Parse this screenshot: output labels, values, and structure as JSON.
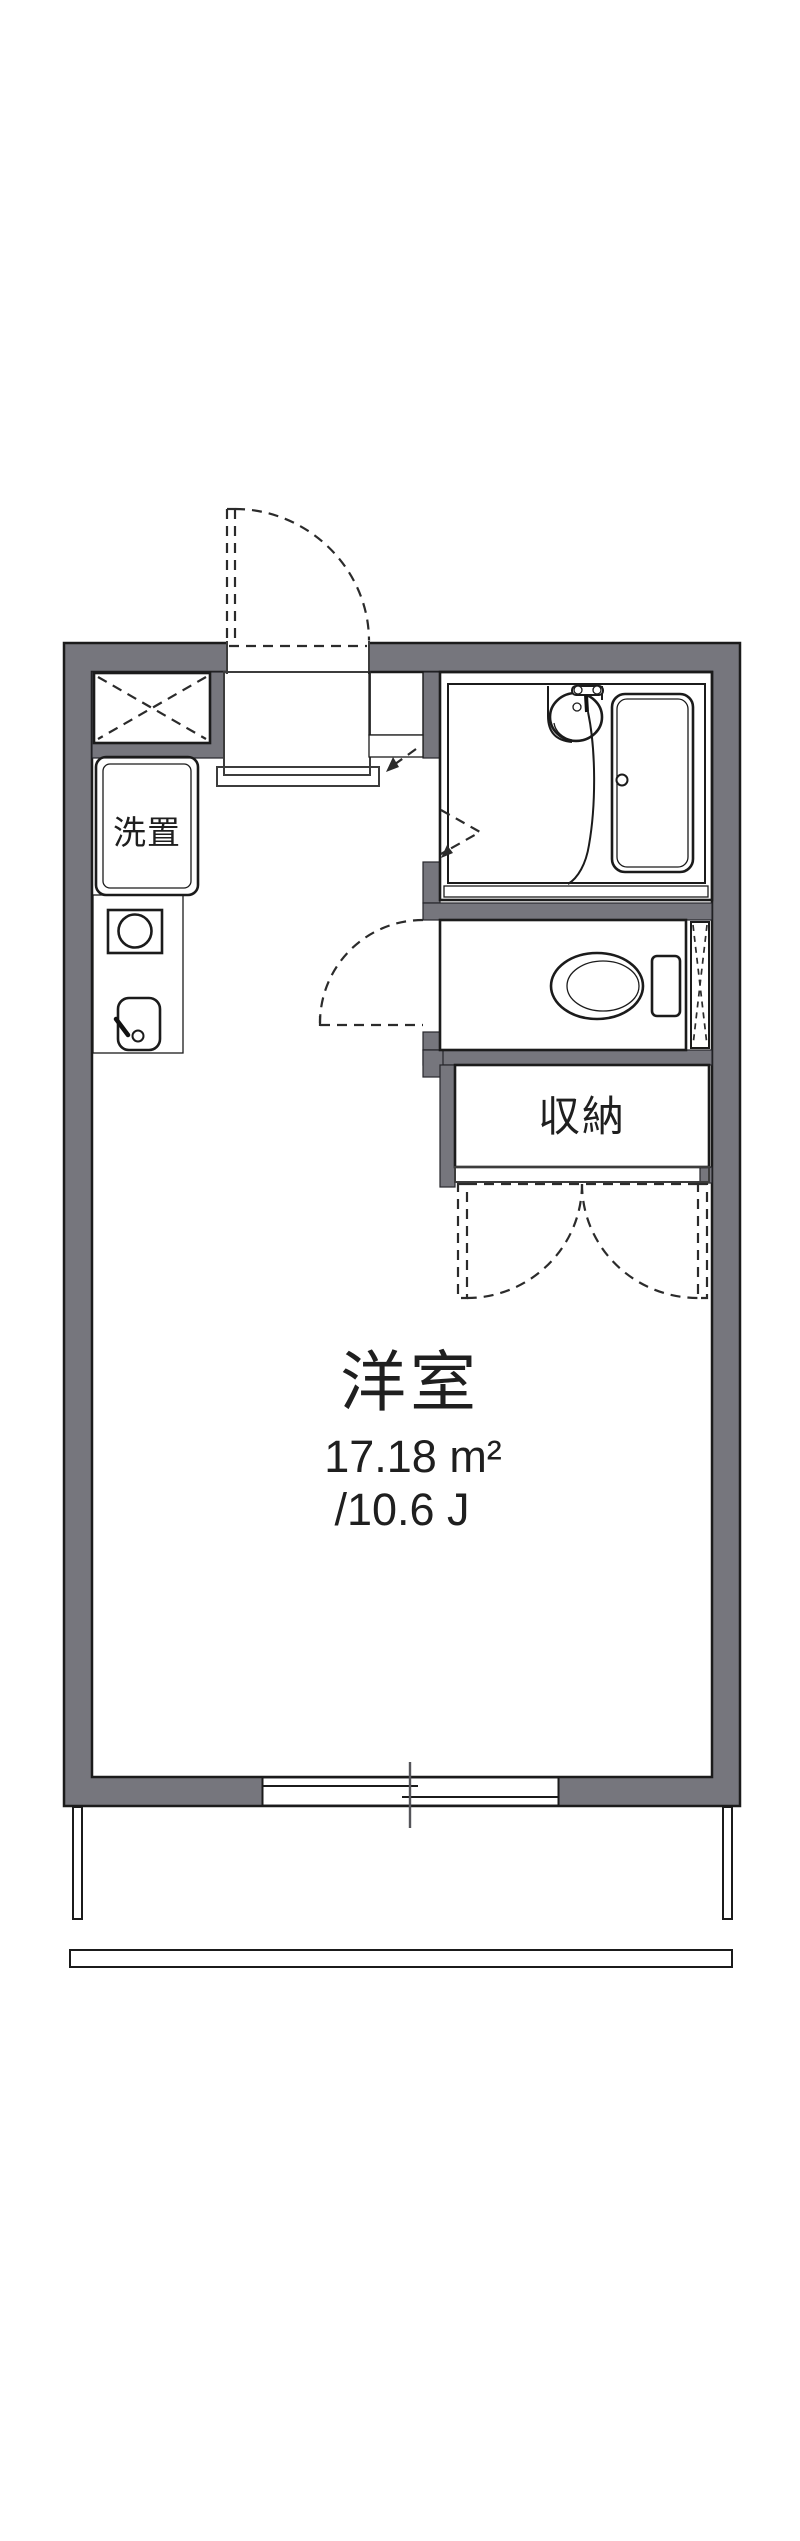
{
  "page": {
    "background": "#ffffff",
    "width": 800,
    "height": 2541
  },
  "floor_plan": {
    "type": "japanese-apartment-floor-plan",
    "labels": {
      "main_room": "洋室",
      "area_m2": "17.18 m²",
      "area_tatami": "/10.6 J",
      "storage": "収納",
      "washer": "洗置"
    },
    "rooms": [
      {
        "id": "main-room",
        "label": "洋室",
        "area_m2": "17.18 m²",
        "area_tatami": "/10.6 J"
      },
      {
        "id": "storage-closet",
        "label": "収納"
      },
      {
        "id": "washing-machine-space",
        "label": "洗置"
      },
      {
        "id": "unit-bathroom",
        "label": ""
      },
      {
        "id": "toilet-room",
        "label": ""
      },
      {
        "id": "kitchen",
        "label": ""
      },
      {
        "id": "entrance",
        "label": ""
      }
    ],
    "fixtures": [
      "entrance-door-swing",
      "refrigerator-space",
      "washing-machine-space",
      "gas-stove",
      "kitchen-sink",
      "unit-bathroom",
      "washbasin",
      "bathtub",
      "shower-hose",
      "toilet",
      "pipe-space",
      "storage-closet",
      "closet-double-doors",
      "bathroom-folding-door",
      "toilet-door-swing",
      "sliding-window",
      "balcony-railing"
    ],
    "colors": {
      "wall": "#76767d",
      "outline": "#1b1b1b",
      "room_blue": "#d9e7f8",
      "room_blue_deep": "#d2e1f4",
      "cream": "#f8edd2",
      "dash_line": "#2b2b2b",
      "window_tick": "#55555a",
      "background": "#ffffff",
      "text": "#1f1f1f"
    }
  }
}
